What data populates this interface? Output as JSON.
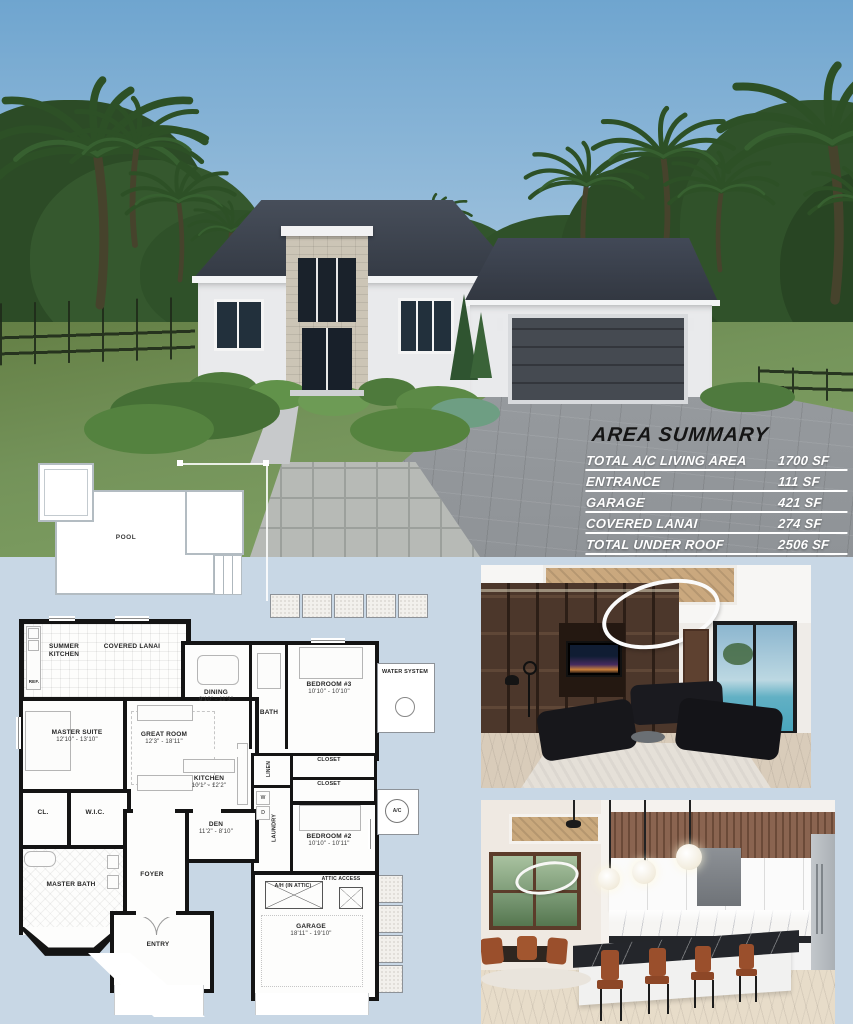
{
  "area_summary": {
    "title": "AREA SUMMARY",
    "rows": [
      {
        "label": "TOTAL A/C LIVING AREA",
        "value": "1700 SF"
      },
      {
        "label": "ENTRANCE",
        "value": "111 SF"
      },
      {
        "label": "GARAGE",
        "value": "421 SF"
      },
      {
        "label": "COVERED LANAI",
        "value": "274 SF"
      },
      {
        "label": "TOTAL UNDER ROOF",
        "value": "2506 SF"
      }
    ]
  },
  "site_plan": {
    "pool": "POOL"
  },
  "floor_plan": {
    "summer_kitchen": "SUMMER KITCHEN",
    "covered_lanai": "COVERED LANAI",
    "ref": "REF.",
    "master_suite": "MASTER SUITE",
    "master_suite_dims": "12'10\" - 13'10\"",
    "great_room": "GREAT ROOM",
    "great_room_dims": "12'3\" - 18'11\"",
    "dining": "DINING",
    "dining_dims": "9'10\" - 11'3\"",
    "bath": "BATH",
    "bedroom3": "BEDROOM #3",
    "bedroom3_dims": "10'10\" - 10'10\"",
    "water_system": "WATER SYSTEM",
    "closet_a": "CLOSET",
    "closet_b": "CLOSET",
    "bedroom2": "BEDROOM #2",
    "bedroom2_dims": "10'10\" - 10'11\"",
    "linen": "LINEN",
    "laundry": "LAUNDRY",
    "washer": "W",
    "dryer": "D",
    "kitchen": "KITCHEN",
    "kitchen_dims": "10'1\" - 12'2\"",
    "den": "DEN",
    "den_dims": "11'2\" - 8'10\"",
    "foyer": "FOYER",
    "cl": "CL.",
    "wic": "W.I.C.",
    "master_bath": "MASTER BATH",
    "entry": "ENTRY",
    "garage": "GARAGE",
    "garage_dims": "18'11\" - 19'10\"",
    "ah": "A/H (IN ATTIC)",
    "attic_access": "ATTIC ACCESS",
    "ac": "A/C"
  }
}
